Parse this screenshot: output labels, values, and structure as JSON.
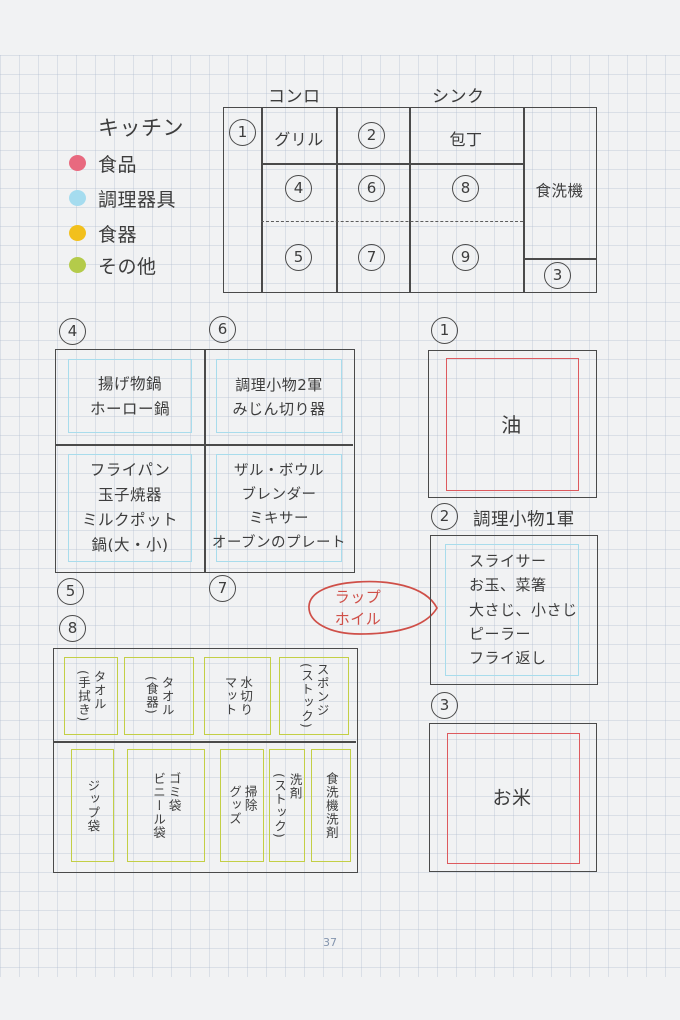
{
  "page_number": "37",
  "legend": {
    "title": "キッチン",
    "items": [
      {
        "label": "食品",
        "color": "#e8697f"
      },
      {
        "label": "調理器具",
        "color": "#a5dcef"
      },
      {
        "label": "食器",
        "color": "#f2c01c"
      },
      {
        "label": "その他",
        "color": "#b4cb4a"
      }
    ]
  },
  "map": {
    "stove": "コンロ",
    "sink": "シンク",
    "n1": "1",
    "grill": "グリル",
    "n2": "2",
    "knife": "包丁",
    "n4": "4",
    "n6": "6",
    "n8": "8",
    "n5": "5",
    "n7": "7",
    "n9": "9",
    "dishwasher": "食洗機",
    "n3": "3"
  },
  "box46": {
    "n4": "4",
    "n6": "6",
    "n5": "5",
    "n7": "7",
    "cell_tl": "揚げ物鍋\nホーロー鍋",
    "cell_tr": "調理小物2軍\nみじん切り器",
    "cell_bl": "フライパン\n玉子焼器\nミルクポット\n鍋(大・小)",
    "cell_br": "ザル・ボウル\nブレンダー\nミキサー\nオーブンのプレート"
  },
  "box8": {
    "n": "8",
    "row1": {
      "c1": "タオル\n(手拭き)",
      "c2": "タオル\n(食器)",
      "c3": "水切り\nマット",
      "c4": "スポンジ\n(ストック)"
    },
    "row2": {
      "c1": "ジップ袋",
      "c2": "ゴミ袋\nビニール袋",
      "c3": "掃除\nグッズ",
      "c4": "洗剤\n(ストック)",
      "c5": "食洗機洗剤"
    }
  },
  "box1": {
    "n": "1",
    "text": "油"
  },
  "box2": {
    "n": "2",
    "title": "調理小物1軍",
    "items": "スライサー\nお玉、菜箸\n大さじ、小さじ\nピーラー\nフライ返し"
  },
  "box3": {
    "n": "3",
    "text": "お米"
  },
  "bubble": {
    "text": "ラップ\nホイル"
  },
  "colors": {
    "pen": "#3d3d3d",
    "red_ink": "#dd5a5e",
    "blue_ink": "#a8dcec",
    "yellow_green_ink": "#c3cf45",
    "page_number": "#8495ae"
  }
}
